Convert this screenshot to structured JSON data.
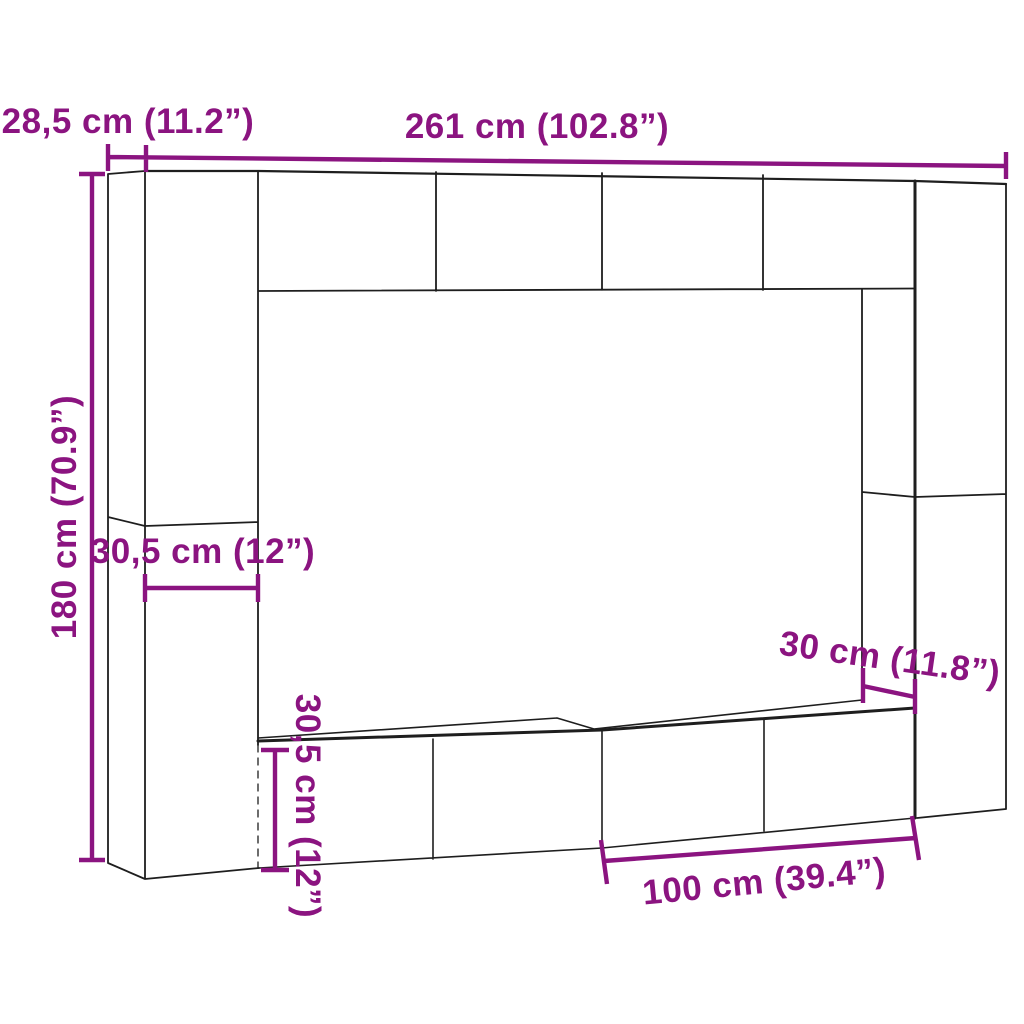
{
  "diagram": {
    "description": "Wall-mounted TV cabinet set dimension drawing",
    "unit_system": "cm / inches",
    "labels": {
      "total_width": "261 cm (102.8”)",
      "depth": "28,5 cm (11.2”)",
      "total_height": "180 cm (70.9”)",
      "side_cabinet_width": "30,5 cm (12”)",
      "right_cabinet_width": "30 cm (11.8”)",
      "bottom_cabinet_height": "30,5 cm (12”)",
      "bottom_cabinet_width": "100 cm (39.4”)"
    },
    "colors": {
      "dimension": "#8B1480",
      "outline": "#1E1E1E",
      "background": "#FFFFFF"
    }
  }
}
